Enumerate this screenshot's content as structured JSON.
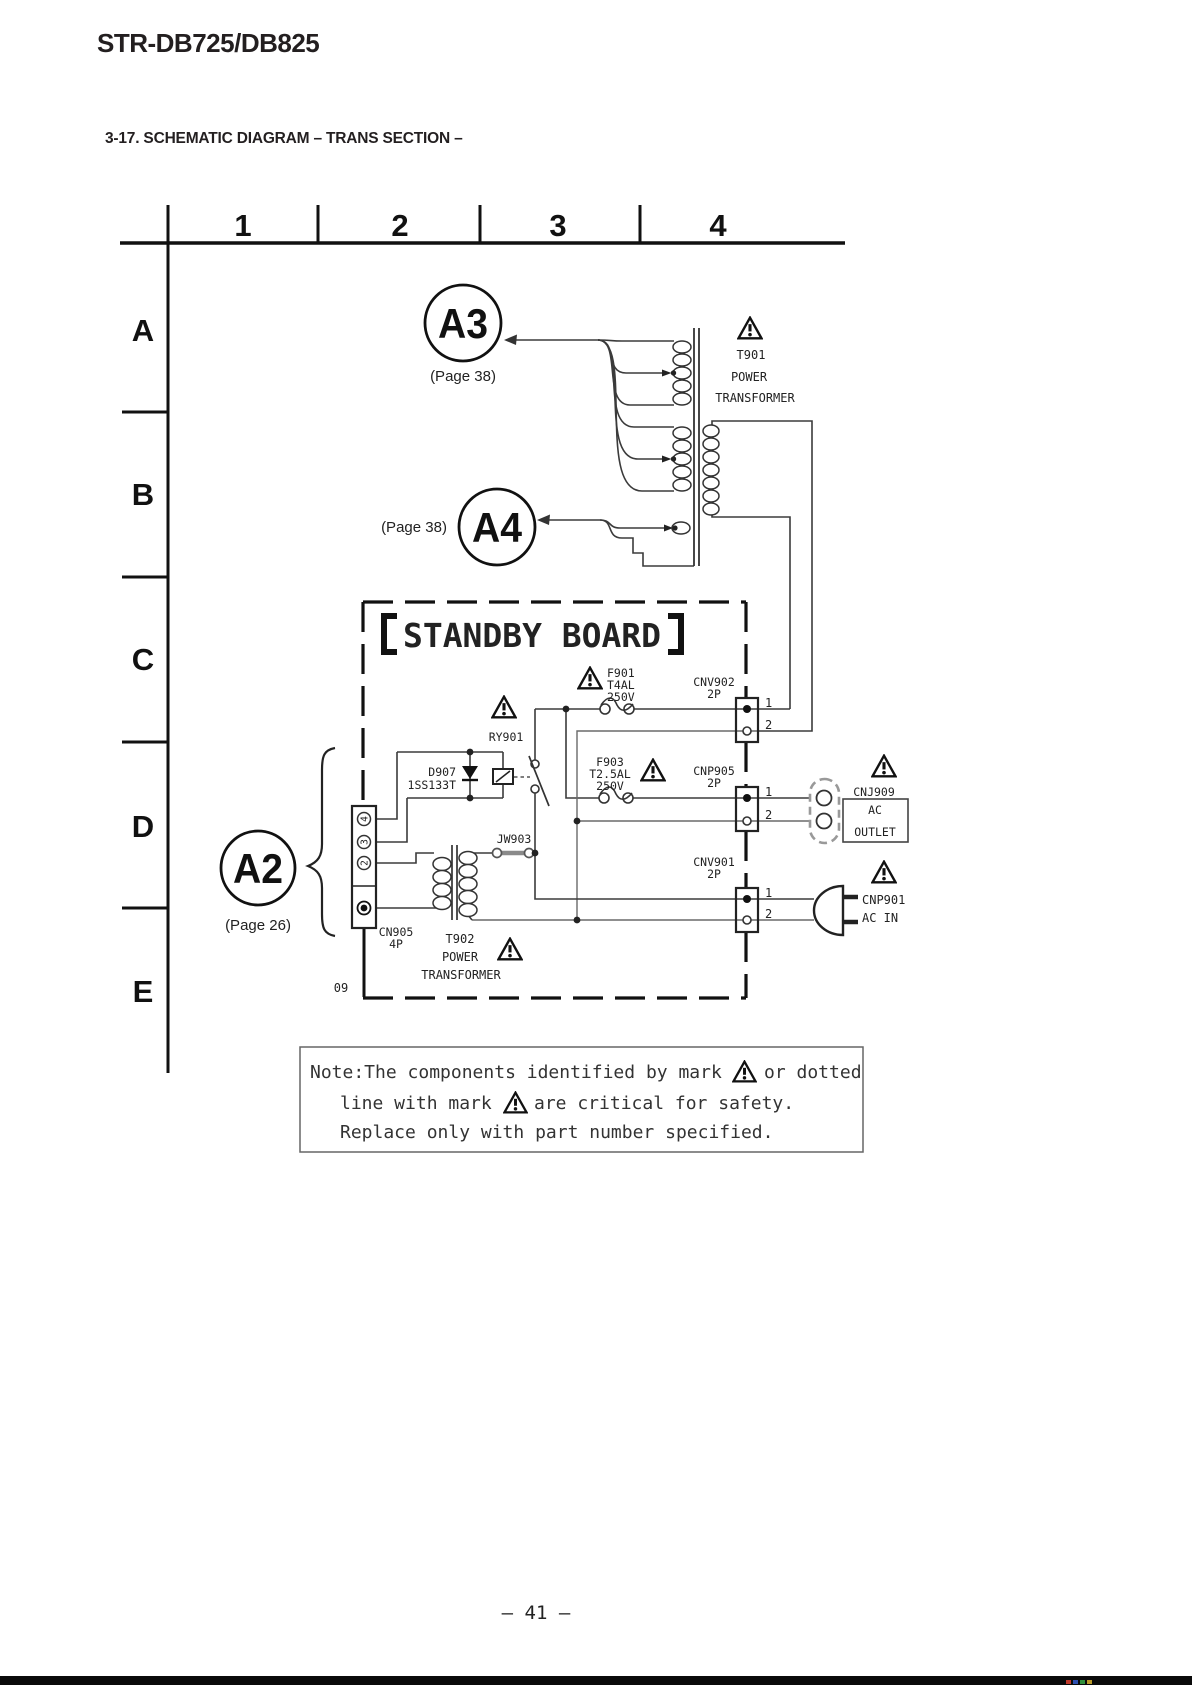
{
  "header": {
    "model": "STR-DB725/DB825",
    "section": "3-17. SCHEMATIC DIAGRAM – TRANS SECTION –"
  },
  "grid": {
    "cols": [
      "1",
      "2",
      "3",
      "4"
    ],
    "rows": [
      "A",
      "B",
      "C",
      "D",
      "E"
    ]
  },
  "refs": {
    "a3": {
      "label": "A3",
      "page": "(Page 38)"
    },
    "a4": {
      "label": "A4",
      "page": "(Page 38)"
    },
    "a2": {
      "label": "A2",
      "page": "(Page 26)"
    }
  },
  "board": {
    "title": "STANDBY BOARD",
    "code": "09"
  },
  "components": {
    "t901": {
      "ref": "T901",
      "name1": "POWER",
      "name2": "TRANSFORMER"
    },
    "t902": {
      "ref": "T902",
      "name1": "POWER",
      "name2": "TRANSFORMER"
    },
    "f901": {
      "ref": "F901",
      "rating1": "T4AL",
      "rating2": "250V"
    },
    "f903": {
      "ref": "F903",
      "rating1": "T2.5AL",
      "rating2": "250V"
    },
    "ry901": {
      "ref": "RY901"
    },
    "d907": {
      "ref": "D907",
      "part": "1SS133T"
    },
    "jw903": {
      "ref": "JW903"
    },
    "cn905": {
      "ref": "CN905",
      "size": "4P",
      "pin4": "4",
      "pin3": "3",
      "pin2": "2"
    },
    "cnv902": {
      "ref": "CNV902",
      "size": "2P",
      "p1": "1",
      "p2": "2"
    },
    "cnp905": {
      "ref": "CNP905",
      "size": "2P",
      "p1": "1",
      "p2": "2"
    },
    "cnv901": {
      "ref": "CNV901",
      "size": "2P",
      "p1": "1",
      "p2": "2"
    },
    "cnj909": {
      "ref": "CNJ909",
      "name1": "AC",
      "name2": "OUTLET"
    },
    "cnp901": {
      "ref": "CNP901",
      "name": "AC IN"
    }
  },
  "note": {
    "line1a": "Note:The components identified by mark",
    "line1b": "or dotted",
    "line2a": "line with mark",
    "line2b": "are critical for safety.",
    "line3": "Replace only with part number specified."
  },
  "footer": {
    "page": "– 41 –"
  }
}
